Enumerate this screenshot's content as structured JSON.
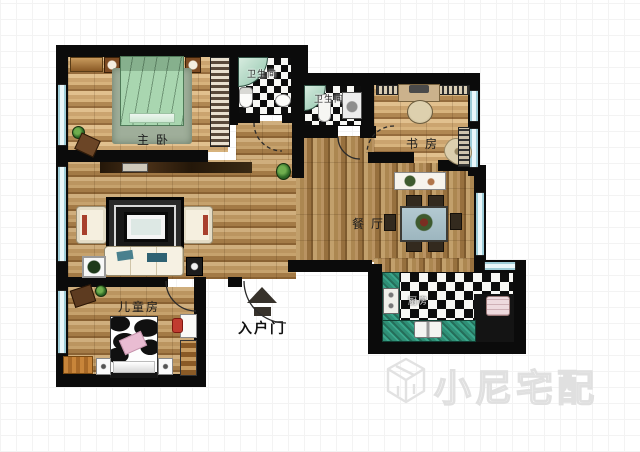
{
  "floorplan": {
    "rooms": {
      "master_bedroom": {
        "label": "主卧"
      },
      "bathroom_1": {
        "label": "卫生间"
      },
      "bathroom_2": {
        "label": "卫生间"
      },
      "study": {
        "label": "书房"
      },
      "dining_room": {
        "label": "餐厅"
      },
      "kitchen": {
        "label": "厨房"
      },
      "kids_room": {
        "label": "儿童房"
      },
      "entry_door": {
        "label": "入户门"
      }
    },
    "watermark": {
      "brand_text": "小尼宅配",
      "logo": "cube-n-logo"
    },
    "colors": {
      "wall": "#0b0b0b",
      "wood": "#b9945f",
      "tile_dark": "#0d0d0d",
      "tile_light": "#f7f7f4",
      "counter_teal": "#2f8f76",
      "window_blue": "#b6dde6",
      "bed_green": "#a9d6b0",
      "kids_pink": "#e8b9cf",
      "watermark_gray": "#e0e0e0"
    }
  }
}
